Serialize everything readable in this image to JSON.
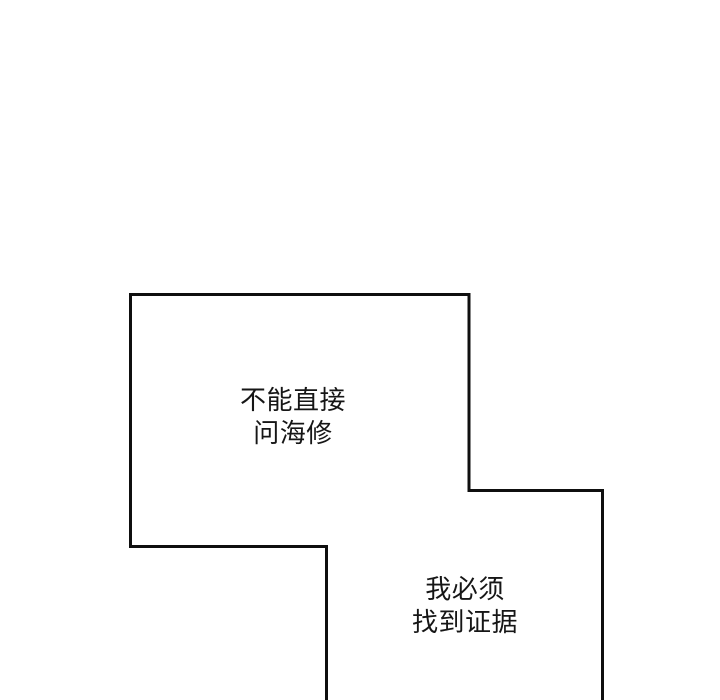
{
  "page": {
    "background": "#ffffff"
  },
  "colors": {
    "outline": "#0f0f0f",
    "ink": "#161616"
  },
  "bubbles": [
    {
      "name": "narration-box-1",
      "lines": [
        "不能直接",
        "问海修"
      ]
    },
    {
      "name": "narration-box-2",
      "lines": [
        "我必须",
        "找到证据"
      ]
    }
  ]
}
